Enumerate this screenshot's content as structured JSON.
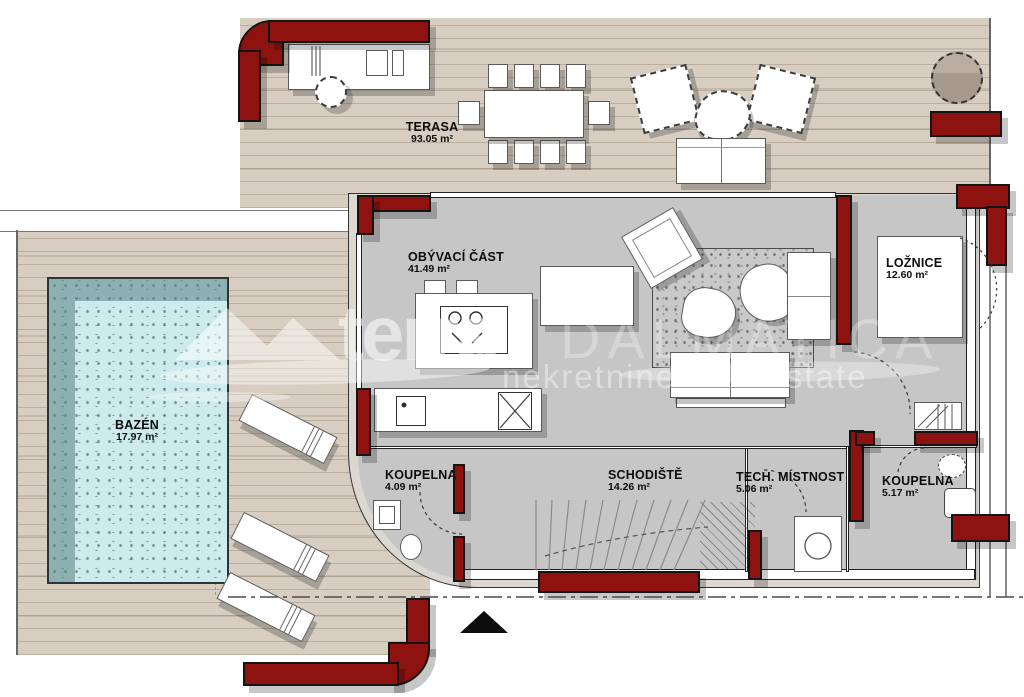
{
  "plan": {
    "rooms": [
      {
        "id": "terasa",
        "name": "TERASA",
        "area": "93.05 m²"
      },
      {
        "id": "obyvaci-cast",
        "name": "OBÝVACÍ ČÁST",
        "area": "41.49 m²"
      },
      {
        "id": "loznice",
        "name": "LOŽNICE",
        "area": "12.60 m²"
      },
      {
        "id": "bazen",
        "name": "BAZÉN",
        "area": "17.97 m²"
      },
      {
        "id": "koupelna-1",
        "name": "KOUPELNA",
        "area": "4.09 m²"
      },
      {
        "id": "schodiste",
        "name": "SCHODIŠTĚ",
        "area": "14.26 m²"
      },
      {
        "id": "tech-mistnost",
        "name": "TECH. MÍSTNOST",
        "area": "5.06 m²"
      },
      {
        "id": "koupelna-2",
        "name": "KOUPELNA",
        "area": "5.17 m²"
      }
    ]
  },
  "watermark": {
    "brand_primary": "terra",
    "brand_secondary": "DALMATICA",
    "tagline_left": "nekretnine",
    "tagline_right": "state"
  },
  "colors": {
    "wall_red": "#8e1310",
    "terrace_wood": "#d7cdc0",
    "interior_gray": "#c6c6c6",
    "pool_water": "#cdeaec",
    "pool_shadow": "#5a8284",
    "outline": "#141414"
  }
}
